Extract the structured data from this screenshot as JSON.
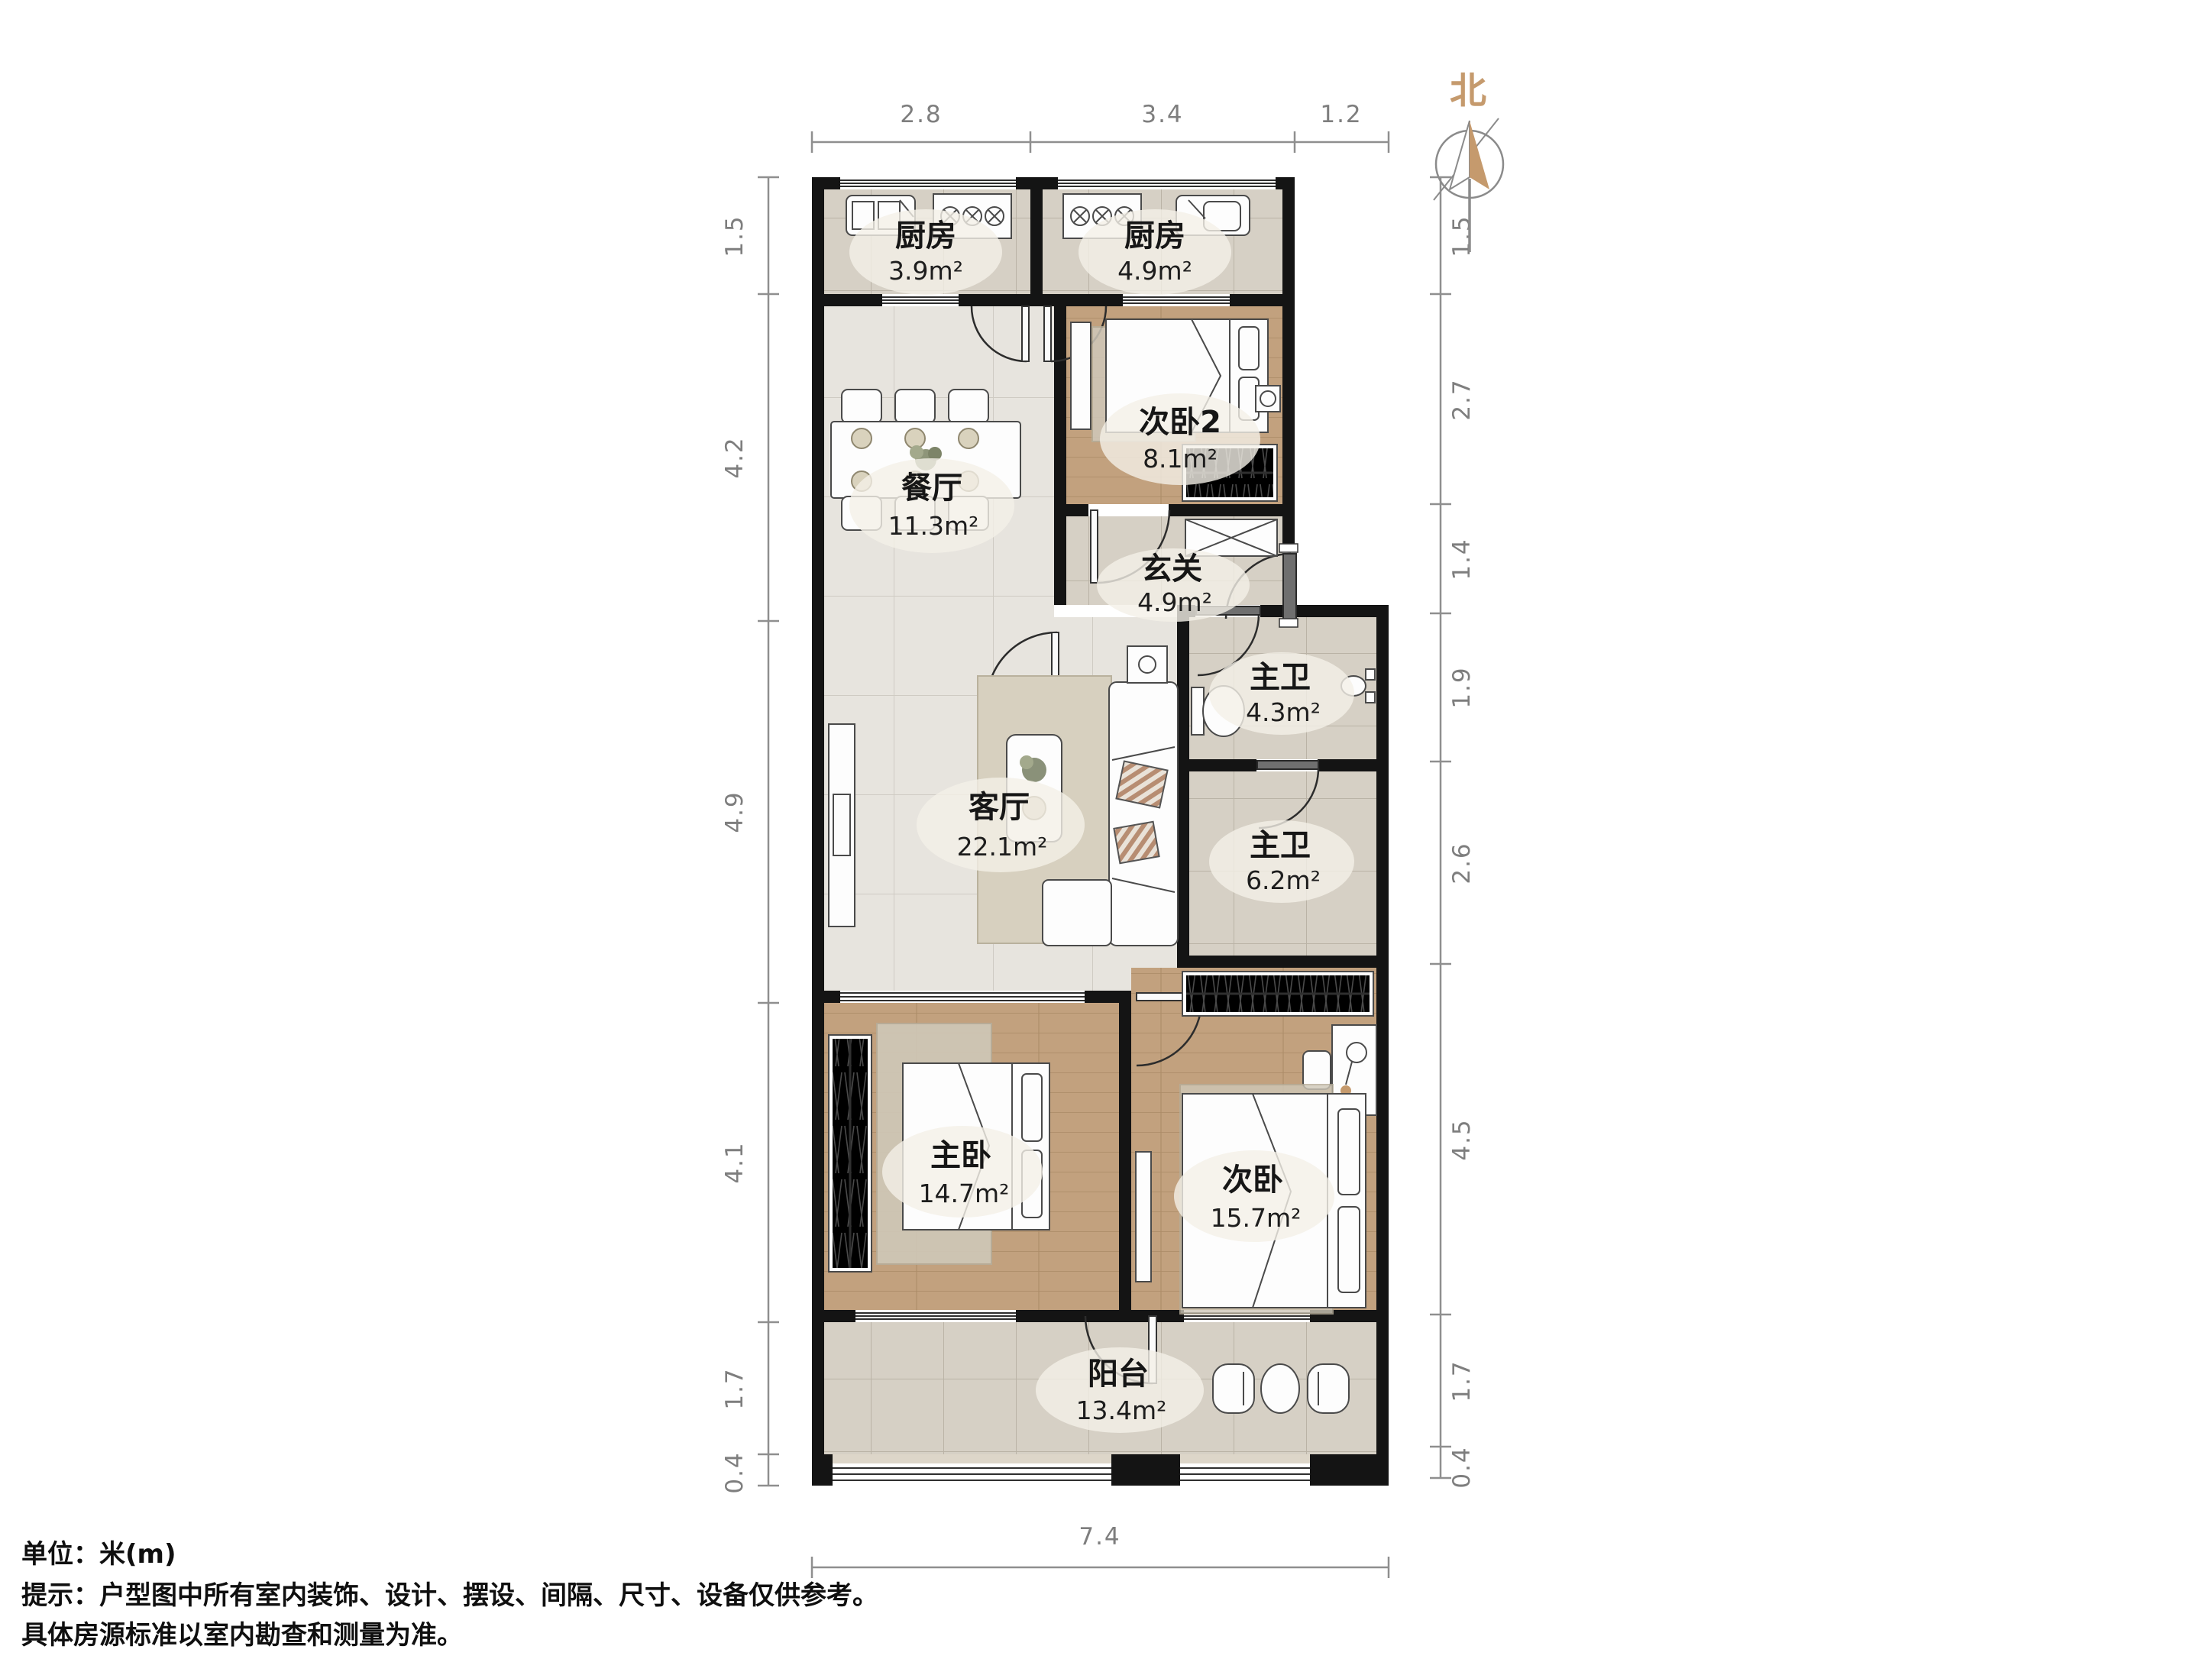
{
  "compass": {
    "label": "北"
  },
  "rooms": [
    {
      "name": "厨房",
      "area": "3.9m²"
    },
    {
      "name": "厨房",
      "area": "4.9m²"
    },
    {
      "name": "次卧2",
      "area": "8.1m²"
    },
    {
      "name": "餐厅",
      "area": "11.3m²"
    },
    {
      "name": "玄关",
      "area": "4.9m²"
    },
    {
      "name": "主卫",
      "area": "4.3m²"
    },
    {
      "name": "主卫",
      "area": "6.2m²"
    },
    {
      "name": "客厅",
      "area": "22.1m²"
    },
    {
      "name": "主卧",
      "area": "14.7m²"
    },
    {
      "name": "次卧",
      "area": "15.7m²"
    },
    {
      "name": "阳台",
      "area": "13.4m²"
    }
  ],
  "dimensions": {
    "top": [
      "2.8",
      "3.4",
      "1.2"
    ],
    "left": [
      "1.5",
      "4.2",
      "4.9",
      "4.1",
      "1.7",
      "0.4"
    ],
    "right": [
      "1.5",
      "2.7",
      "1.4",
      "1.9",
      "2.6",
      "4.5",
      "1.7",
      "0.4"
    ],
    "bottom": [
      "7.4"
    ]
  },
  "notes": {
    "unit": "单位：米(m)",
    "line1": "提示：户型图中所有室内装饰、设计、摆设、间隔、尺寸、设备仅供参考。",
    "line2": "具体房源标准以室内勘查和测量为准。"
  },
  "colors": {
    "wall": "#141414",
    "north": "#c59a6d",
    "dimension": "#8a8a8a",
    "wood_floor": "#c2a17e",
    "tile_floor": "#d6d0c5",
    "marble_floor": "#e7e4de"
  }
}
